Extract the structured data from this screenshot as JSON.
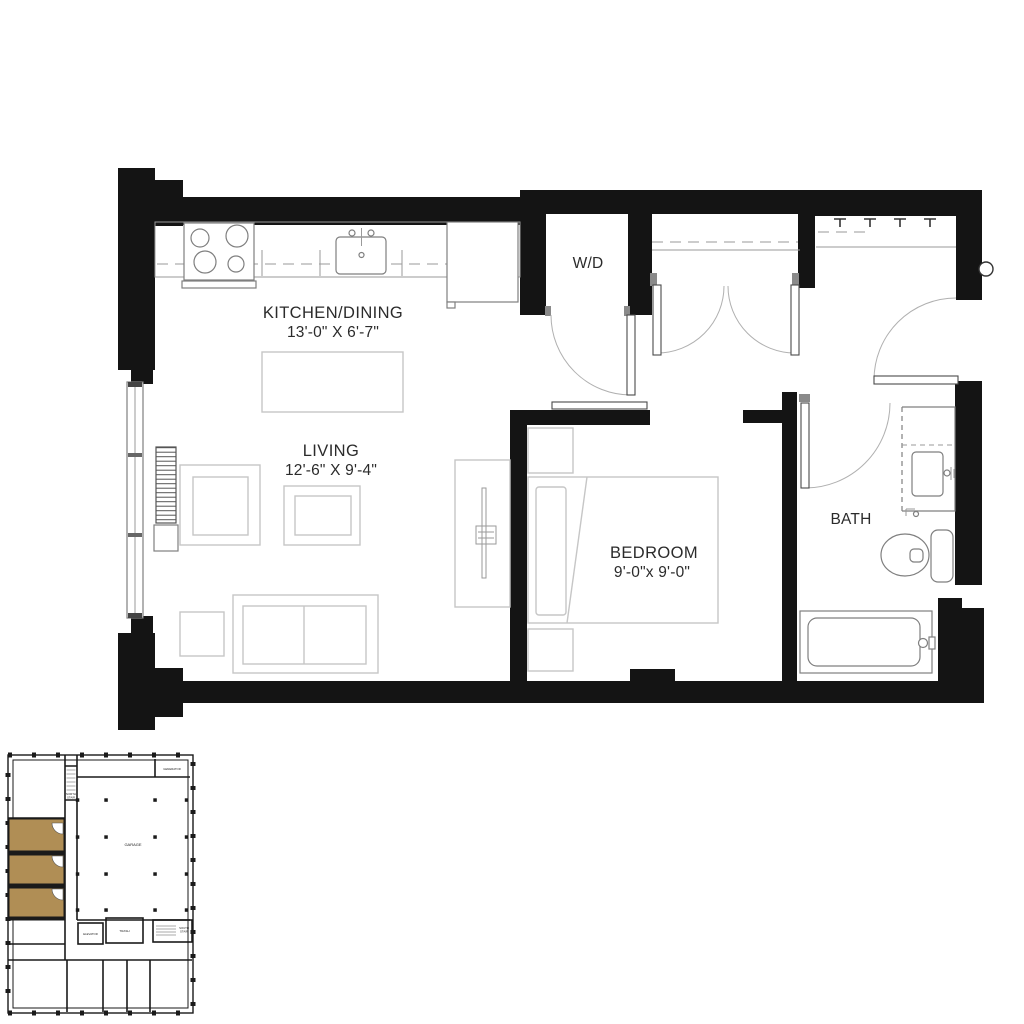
{
  "colors": {
    "wall": "#141414",
    "fixture": "#7f7f7f",
    "furniture": "#c6c6c6",
    "door_arc": "#b0b0b0",
    "line": "#9a9a9a",
    "text": "#2b2b2b",
    "highlight": "#b08e55"
  },
  "plan": {
    "kitchen": {
      "label": "KITCHEN/DINING",
      "dims": "13'-0\" X 6'-7\""
    },
    "living": {
      "label": "LIVING",
      "dims": "12'-6\" X 9'-4\""
    },
    "bedroom": {
      "label": "BEDROOM",
      "dims": "9'-0\"x 9'-0\""
    },
    "bath": {
      "label": "BATH"
    },
    "laundry": {
      "label": "W/D"
    }
  },
  "locator": {
    "garage": "GARAGE",
    "generator": "GENERATOR",
    "elevator": "ELEVATOR",
    "trash": "TRASH",
    "north_stair_line1": "NORTH",
    "north_stair_line2": "STAIR",
    "south_stair_line1": "SOUTH",
    "south_stair_line2": "STAIR"
  }
}
